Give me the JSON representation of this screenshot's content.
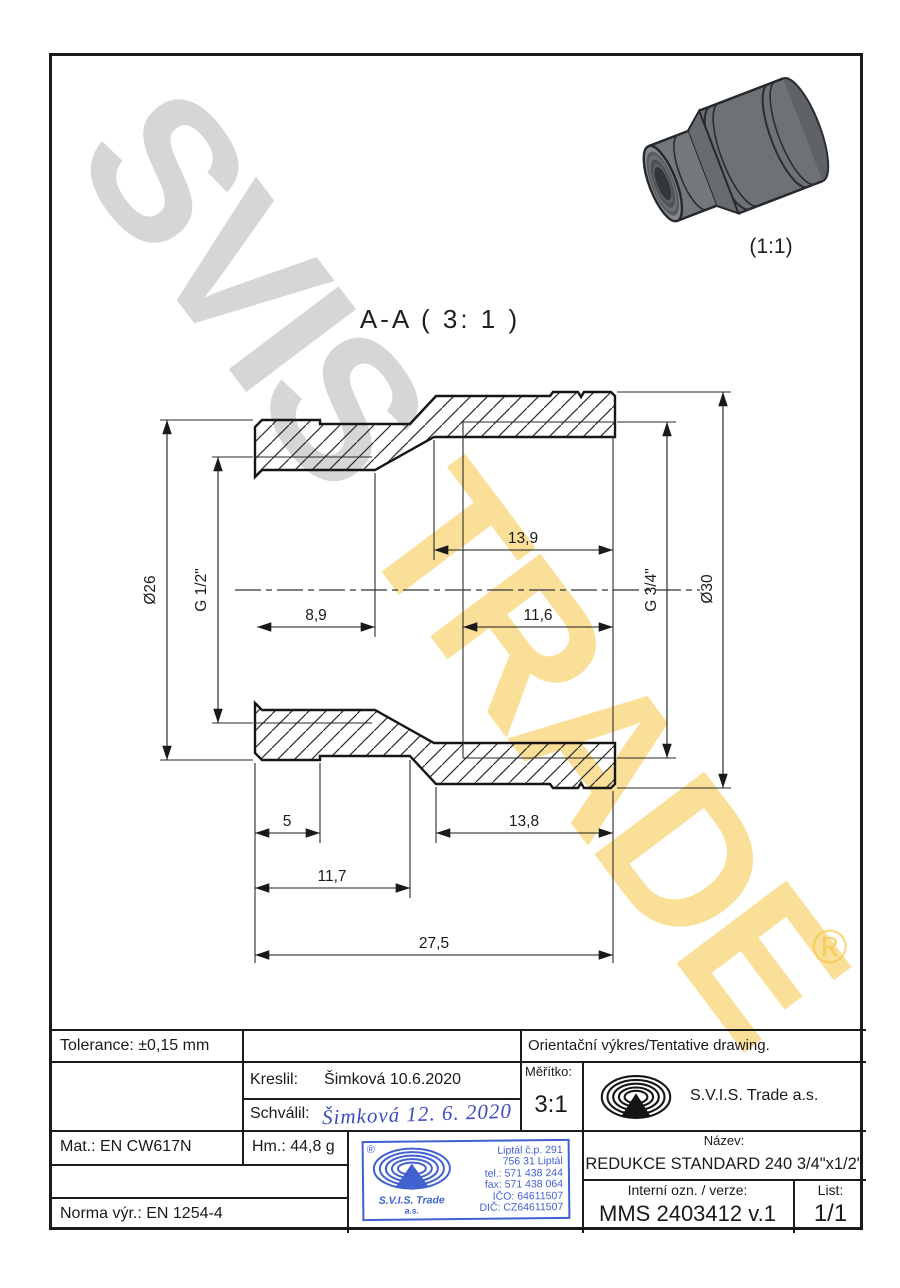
{
  "watermark": {
    "word_gray": "SVIS",
    "word_yellow": " TRADE",
    "registered_mark": "®",
    "gray_color": "rgba(0,0,0,0.16)",
    "yellow_color": "rgba(246,197,67,0.55)"
  },
  "pictorial": {
    "scale_label": "(1:1)"
  },
  "section_view": {
    "title": "A-A ( 3: 1 )",
    "dimensions": {
      "outer_dia_small": "Ø26",
      "thread_small": "G 1/2\"",
      "thread_depth_small": "8,9",
      "bore_depth_large": "13,9",
      "thread_depth_large": "11,6",
      "thread_large": "G 3/4\"",
      "outer_dia_large": "Ø30",
      "groove_offset_small": "5",
      "small_end_length": "11,7",
      "large_end_length": "13,8",
      "total_length": "27,5"
    }
  },
  "title_block": {
    "tolerance": "Tolerance: ±0,15 mm",
    "orientation_note": "Orientační výkres/Tentative drawing.",
    "kreslil_label": "Kreslil:",
    "kreslil_value": "Šimková 10.6.2020",
    "schvalil_label": "Schválil:",
    "schvalil_signature": "Šimková 12. 6. 2020",
    "meritko_label": "Měřítko:",
    "meritko_value": "3:1",
    "company": "S.V.I.S. Trade a.s.",
    "mat": "Mat.: EN CW617N",
    "hm": "Hm.: 44,8 g",
    "norma": "Norma výr.: EN 1254-4",
    "nazev_label": "Název:",
    "nazev_value": "REDUKCE STANDARD 240 3/4\"x1/2\"",
    "interni_label": "Interní ozn. / verze:",
    "interni_value": "MMS 2403412 v.1",
    "list_label": "List:",
    "list_value": "1/1"
  },
  "stamp": {
    "registered": "®",
    "company_line1": "S.V.I.S. Trade",
    "company_line2": "a.s.",
    "address_lines": [
      "Liptál č.p. 291",
      "756 31 Liptál",
      "tel.: 571 438 244",
      "fax: 571 438 064",
      "IČO: 64611507",
      "DIČ: CZ64611507"
    ],
    "color": "#4161cf"
  }
}
